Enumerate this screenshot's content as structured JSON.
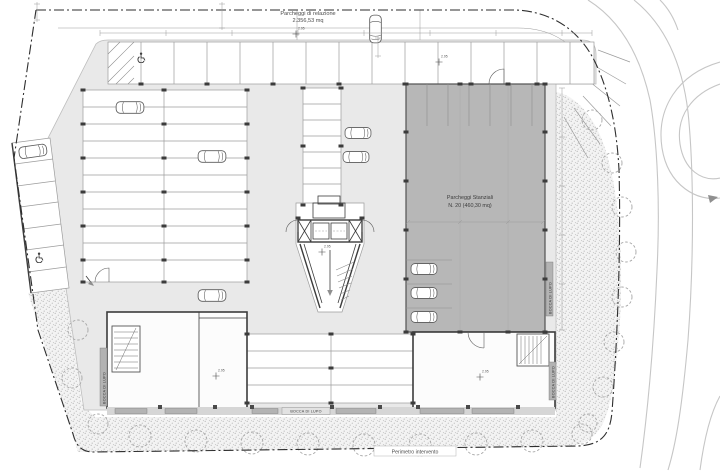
{
  "plan": {
    "labels": {
      "relation_parking_title": "Parcheggi di relazione",
      "relation_parking_area": "2.356,53 mq",
      "permanent_parking_title": "Parcheggi Stanziali",
      "permanent_parking_count": "N. 20 (460,30 mq)",
      "light_well": "BOCCA DI LUPO",
      "perimeter": "Perimetro intervento",
      "spot_elevation": "2.95"
    },
    "colors": {
      "floor": "#e9e9e9",
      "stalls": "#ffffff",
      "stanziali": "#b7b7b7",
      "building": "#fcfcfc",
      "wall": "#3c3c3c",
      "stall_line": "#9c9c9c",
      "boundary": "#2e2e2e",
      "stipple_bg": "#f3f3f3",
      "stipple_dot": "#bcbcbc",
      "tree": "#a6a6a6",
      "road": "#c6c6c6",
      "text": "#4d4d4d"
    }
  }
}
